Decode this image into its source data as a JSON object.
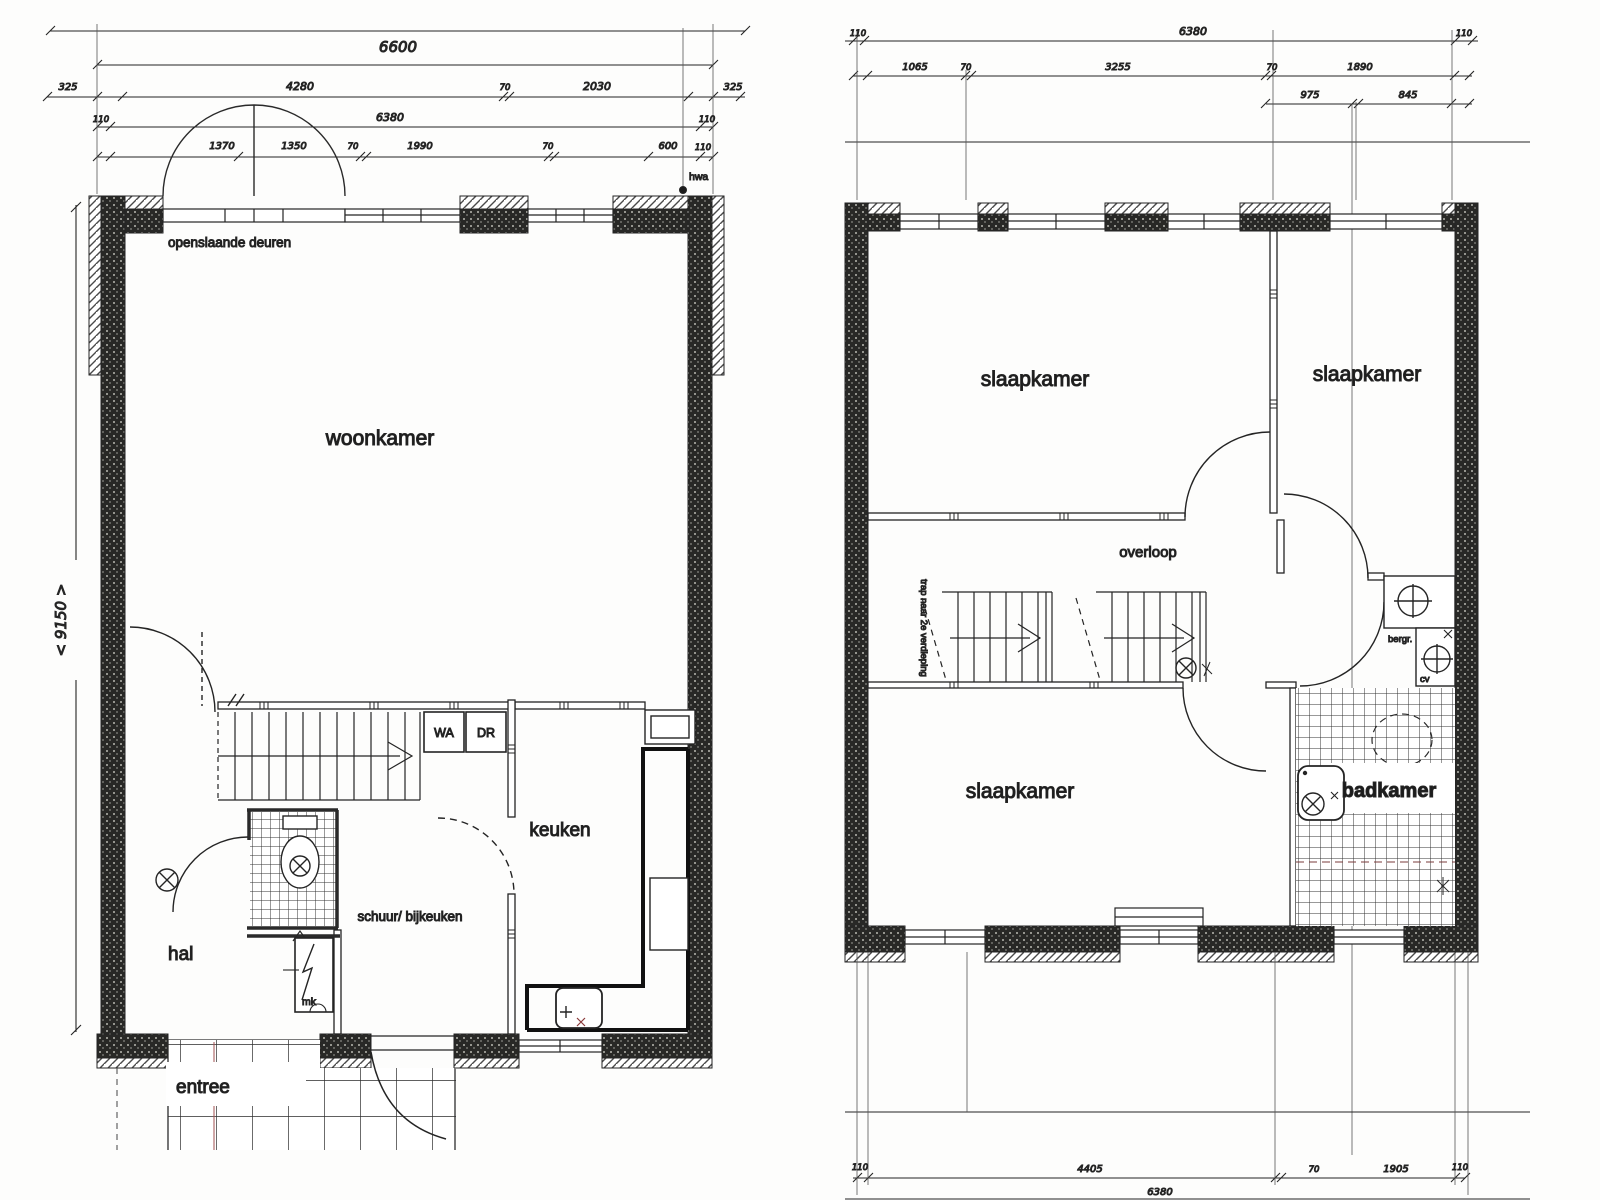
{
  "document": {
    "type": "scanned floor plan, two storeys"
  },
  "ground_floor": {
    "rooms": {
      "woonkamer": "woonkamer",
      "keuken": "keuken",
      "hal": "hal",
      "entree": "entree",
      "schuur": "schuur/ bijkeuken",
      "wash_machine": "WA",
      "dryer": "DR",
      "meter_closet": "mk"
    },
    "labels": {
      "doors": "openslaande deuren",
      "rain_drain": "hwa",
      "depth": "< 9150 >"
    },
    "dims": {
      "total": "6600",
      "row_segments": [
        "325",
        "4280",
        "70",
        "2030",
        "325"
      ],
      "inner_total": "6380",
      "wall": "110",
      "row_detail": [
        "1370",
        "1350",
        "70",
        "1990",
        "70",
        "600",
        "110"
      ]
    }
  },
  "upper_floor": {
    "rooms": {
      "bedroom1": "slaapkamer",
      "bedroom2": "slaapkamer",
      "bedroom3": "slaapkamer",
      "landing": "overloop",
      "bathroom": "badkamer",
      "storage": "bergr.",
      "heater": "cv"
    },
    "labels": {
      "stairs_note": "trap naar 2e verdieping"
    },
    "dims": {
      "total": "6380",
      "wall": "110",
      "row_segments": [
        "1065",
        "70",
        "3255",
        "70",
        "1890"
      ],
      "row_sub": [
        "975",
        "845"
      ],
      "bottom_segments": [
        "4405",
        "70",
        "1905"
      ],
      "bottom_total": "6380"
    }
  }
}
